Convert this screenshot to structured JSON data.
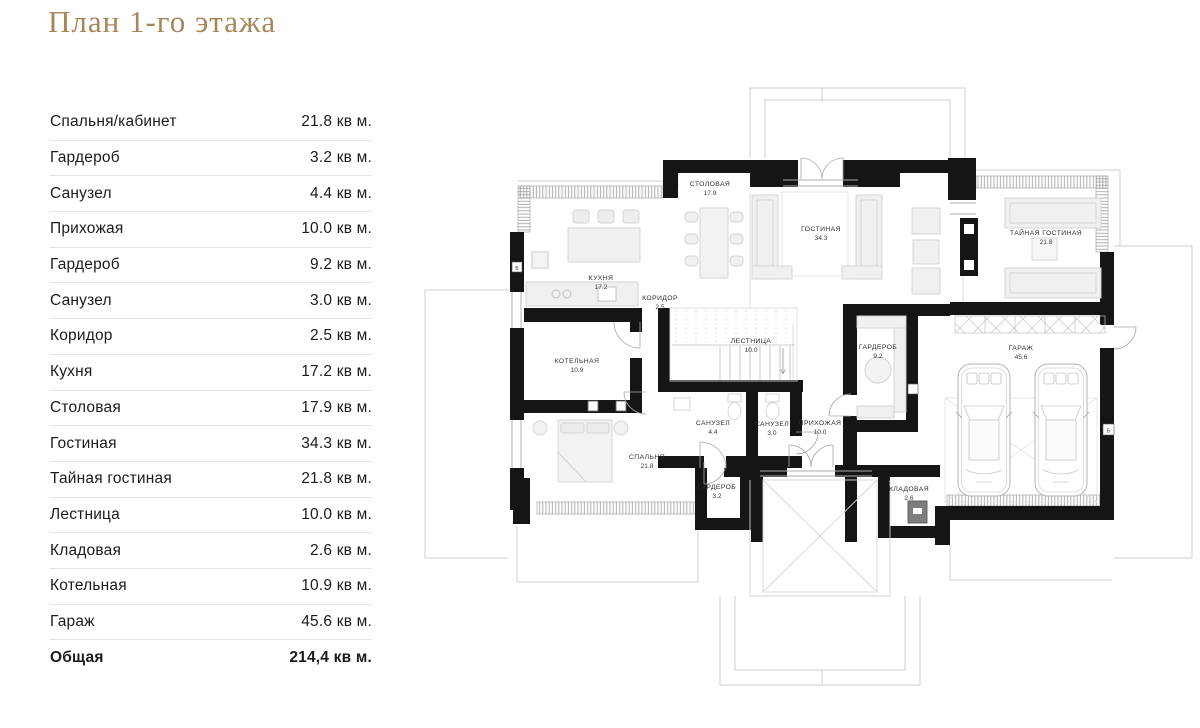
{
  "page_title": "План 1-го этажа",
  "table": {
    "rows": [
      {
        "label": "Спальня/кабинет",
        "value": "21.8 кв м."
      },
      {
        "label": "Гардероб",
        "value": "3.2 кв м."
      },
      {
        "label": "Санузел",
        "value": "4.4 кв м."
      },
      {
        "label": "Прихожая",
        "value": "10.0 кв м."
      },
      {
        "label": "Гардероб",
        "value": "9.2 кв м."
      },
      {
        "label": "Санузел",
        "value": "3.0 кв м."
      },
      {
        "label": "Коридор",
        "value": "2.5 кв м."
      },
      {
        "label": "Кухня",
        "value": "17.2 кв м."
      },
      {
        "label": "Столовая",
        "value": "17.9 кв м."
      },
      {
        "label": "Гостиная",
        "value": "34.3 кв м."
      },
      {
        "label": "Тайная гостиная",
        "value": "21.8 кв м."
      },
      {
        "label": "Лестница",
        "value": "10.0 кв м."
      },
      {
        "label": "Кладовая",
        "value": "2.6 кв м."
      },
      {
        "label": "Котельная",
        "value": "10.9 кв м."
      },
      {
        "label": "Гараж",
        "value": "45.6 кв м."
      }
    ],
    "total": {
      "label": "Общая",
      "value": "214,4 кв м."
    }
  },
  "plan": {
    "vent_label": "Б",
    "rooms": [
      {
        "name": "СТОЛОВАЯ",
        "area": "17.9"
      },
      {
        "name": "ГОСТИНАЯ",
        "area": "34.3"
      },
      {
        "name": "ТАЙНАЯ ГОСТИНАЯ",
        "area": "21.8"
      },
      {
        "name": "КУХНЯ",
        "area": "17.2"
      },
      {
        "name": "КОРИДОР",
        "area": "2.5"
      },
      {
        "name": "ЛЕСТНИЦА",
        "area": "10.0"
      },
      {
        "name": "ГАРДЕРОБ",
        "area": "9.2"
      },
      {
        "name": "ГАРАЖ",
        "area": "45.6"
      },
      {
        "name": "КОТЕЛЬНАЯ",
        "area": "10.9"
      },
      {
        "name": "САНУЗЕЛ",
        "area": "4.4"
      },
      {
        "name": "САНУЗЕЛ",
        "area": "3.0"
      },
      {
        "name": "ПРИХОЖАЯ",
        "area": "10.0"
      },
      {
        "name": "СПАЛЬНЯ",
        "area": "21.8"
      },
      {
        "name": "ГАРДЕРОБ",
        "area": "3.2"
      },
      {
        "name": "КЛАДОВАЯ",
        "area": "2.6"
      }
    ]
  },
  "colors": {
    "accent": "#a5875a",
    "wall": "#151515",
    "thin_line": "#cfcfcf",
    "furniture_stroke": "#d2d2d2",
    "furniture_fill": "#f0f0f0",
    "divider": "#e3e3e3",
    "text": "#1b1b1b"
  }
}
